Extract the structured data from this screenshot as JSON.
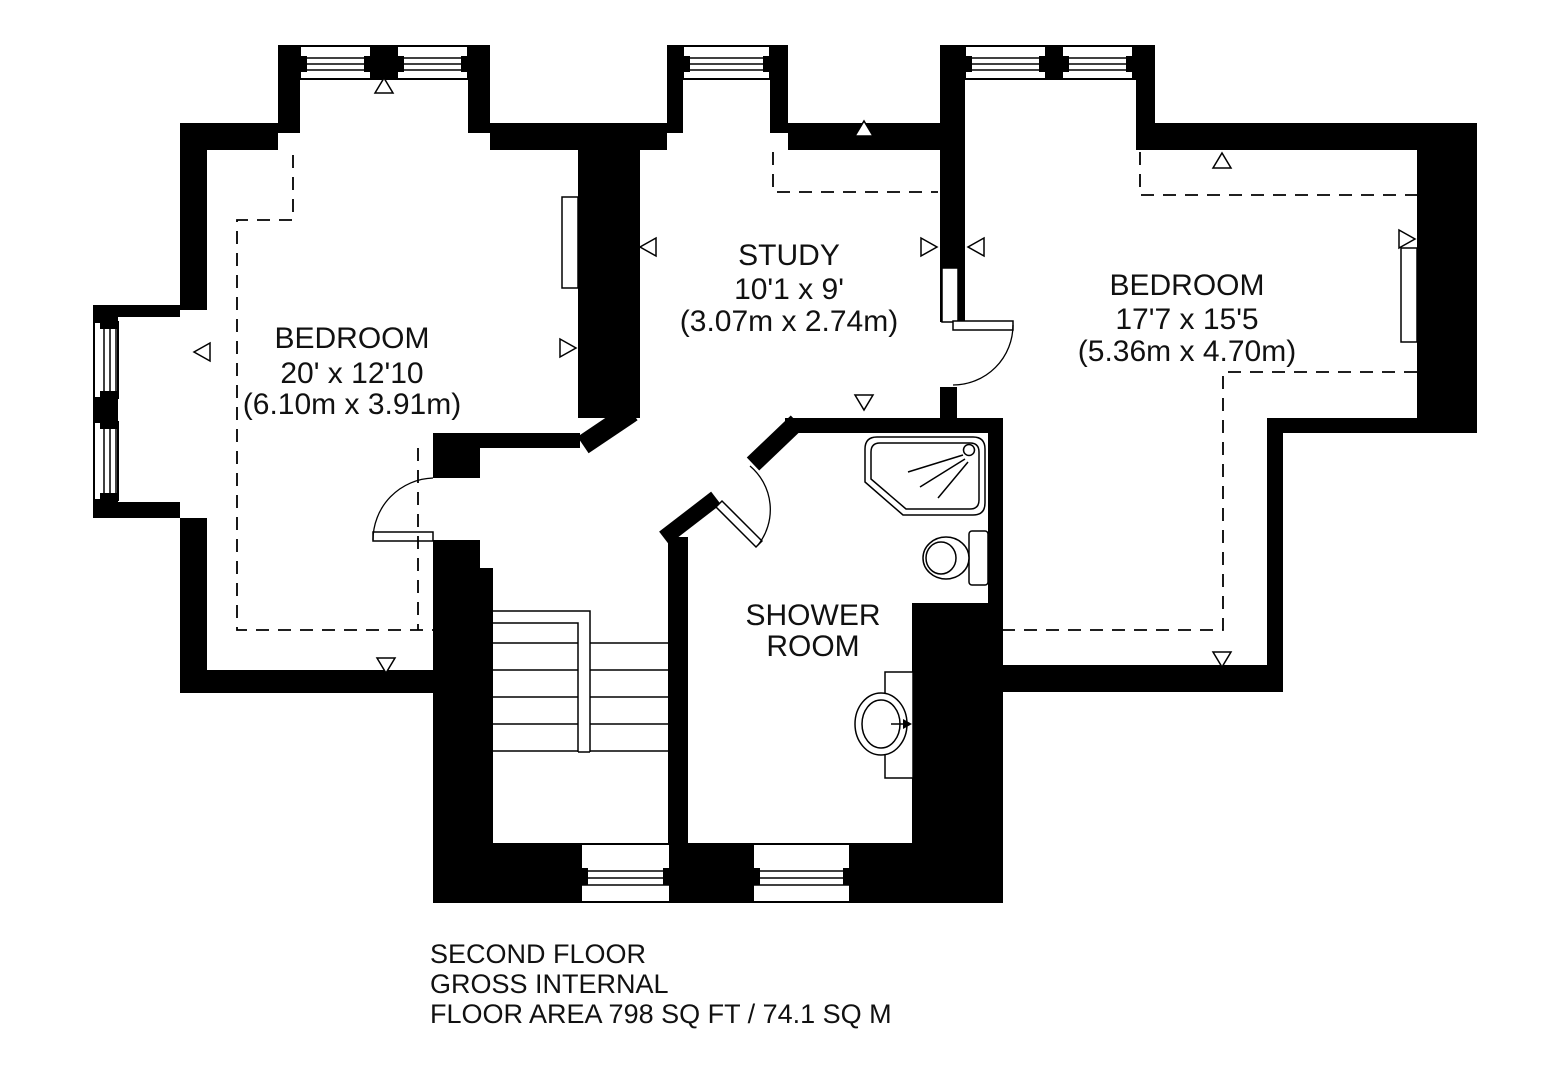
{
  "plan": {
    "colors": {
      "wall": "#000000",
      "background": "#ffffff",
      "text": "#111111"
    },
    "rooms": [
      {
        "id": "bedroom-left",
        "name": "BEDROOM",
        "size_imperial": "20' x 12'10",
        "size_metric": "(6.10m x 3.91m)"
      },
      {
        "id": "study",
        "name": "STUDY",
        "size_imperial": "10'1 x 9'",
        "size_metric": "(3.07m x 2.74m)"
      },
      {
        "id": "bedroom-right",
        "name": "BEDROOM",
        "size_imperial": "17'7 x 15'5",
        "size_metric": "(5.36m x 4.70m)"
      },
      {
        "id": "shower-room",
        "name_line1": "SHOWER",
        "name_line2": "ROOM"
      }
    ],
    "footer": [
      "SECOND FLOOR",
      "GROSS INTERNAL",
      "FLOOR AREA 798 SQ FT / 74.1 SQ M"
    ]
  }
}
